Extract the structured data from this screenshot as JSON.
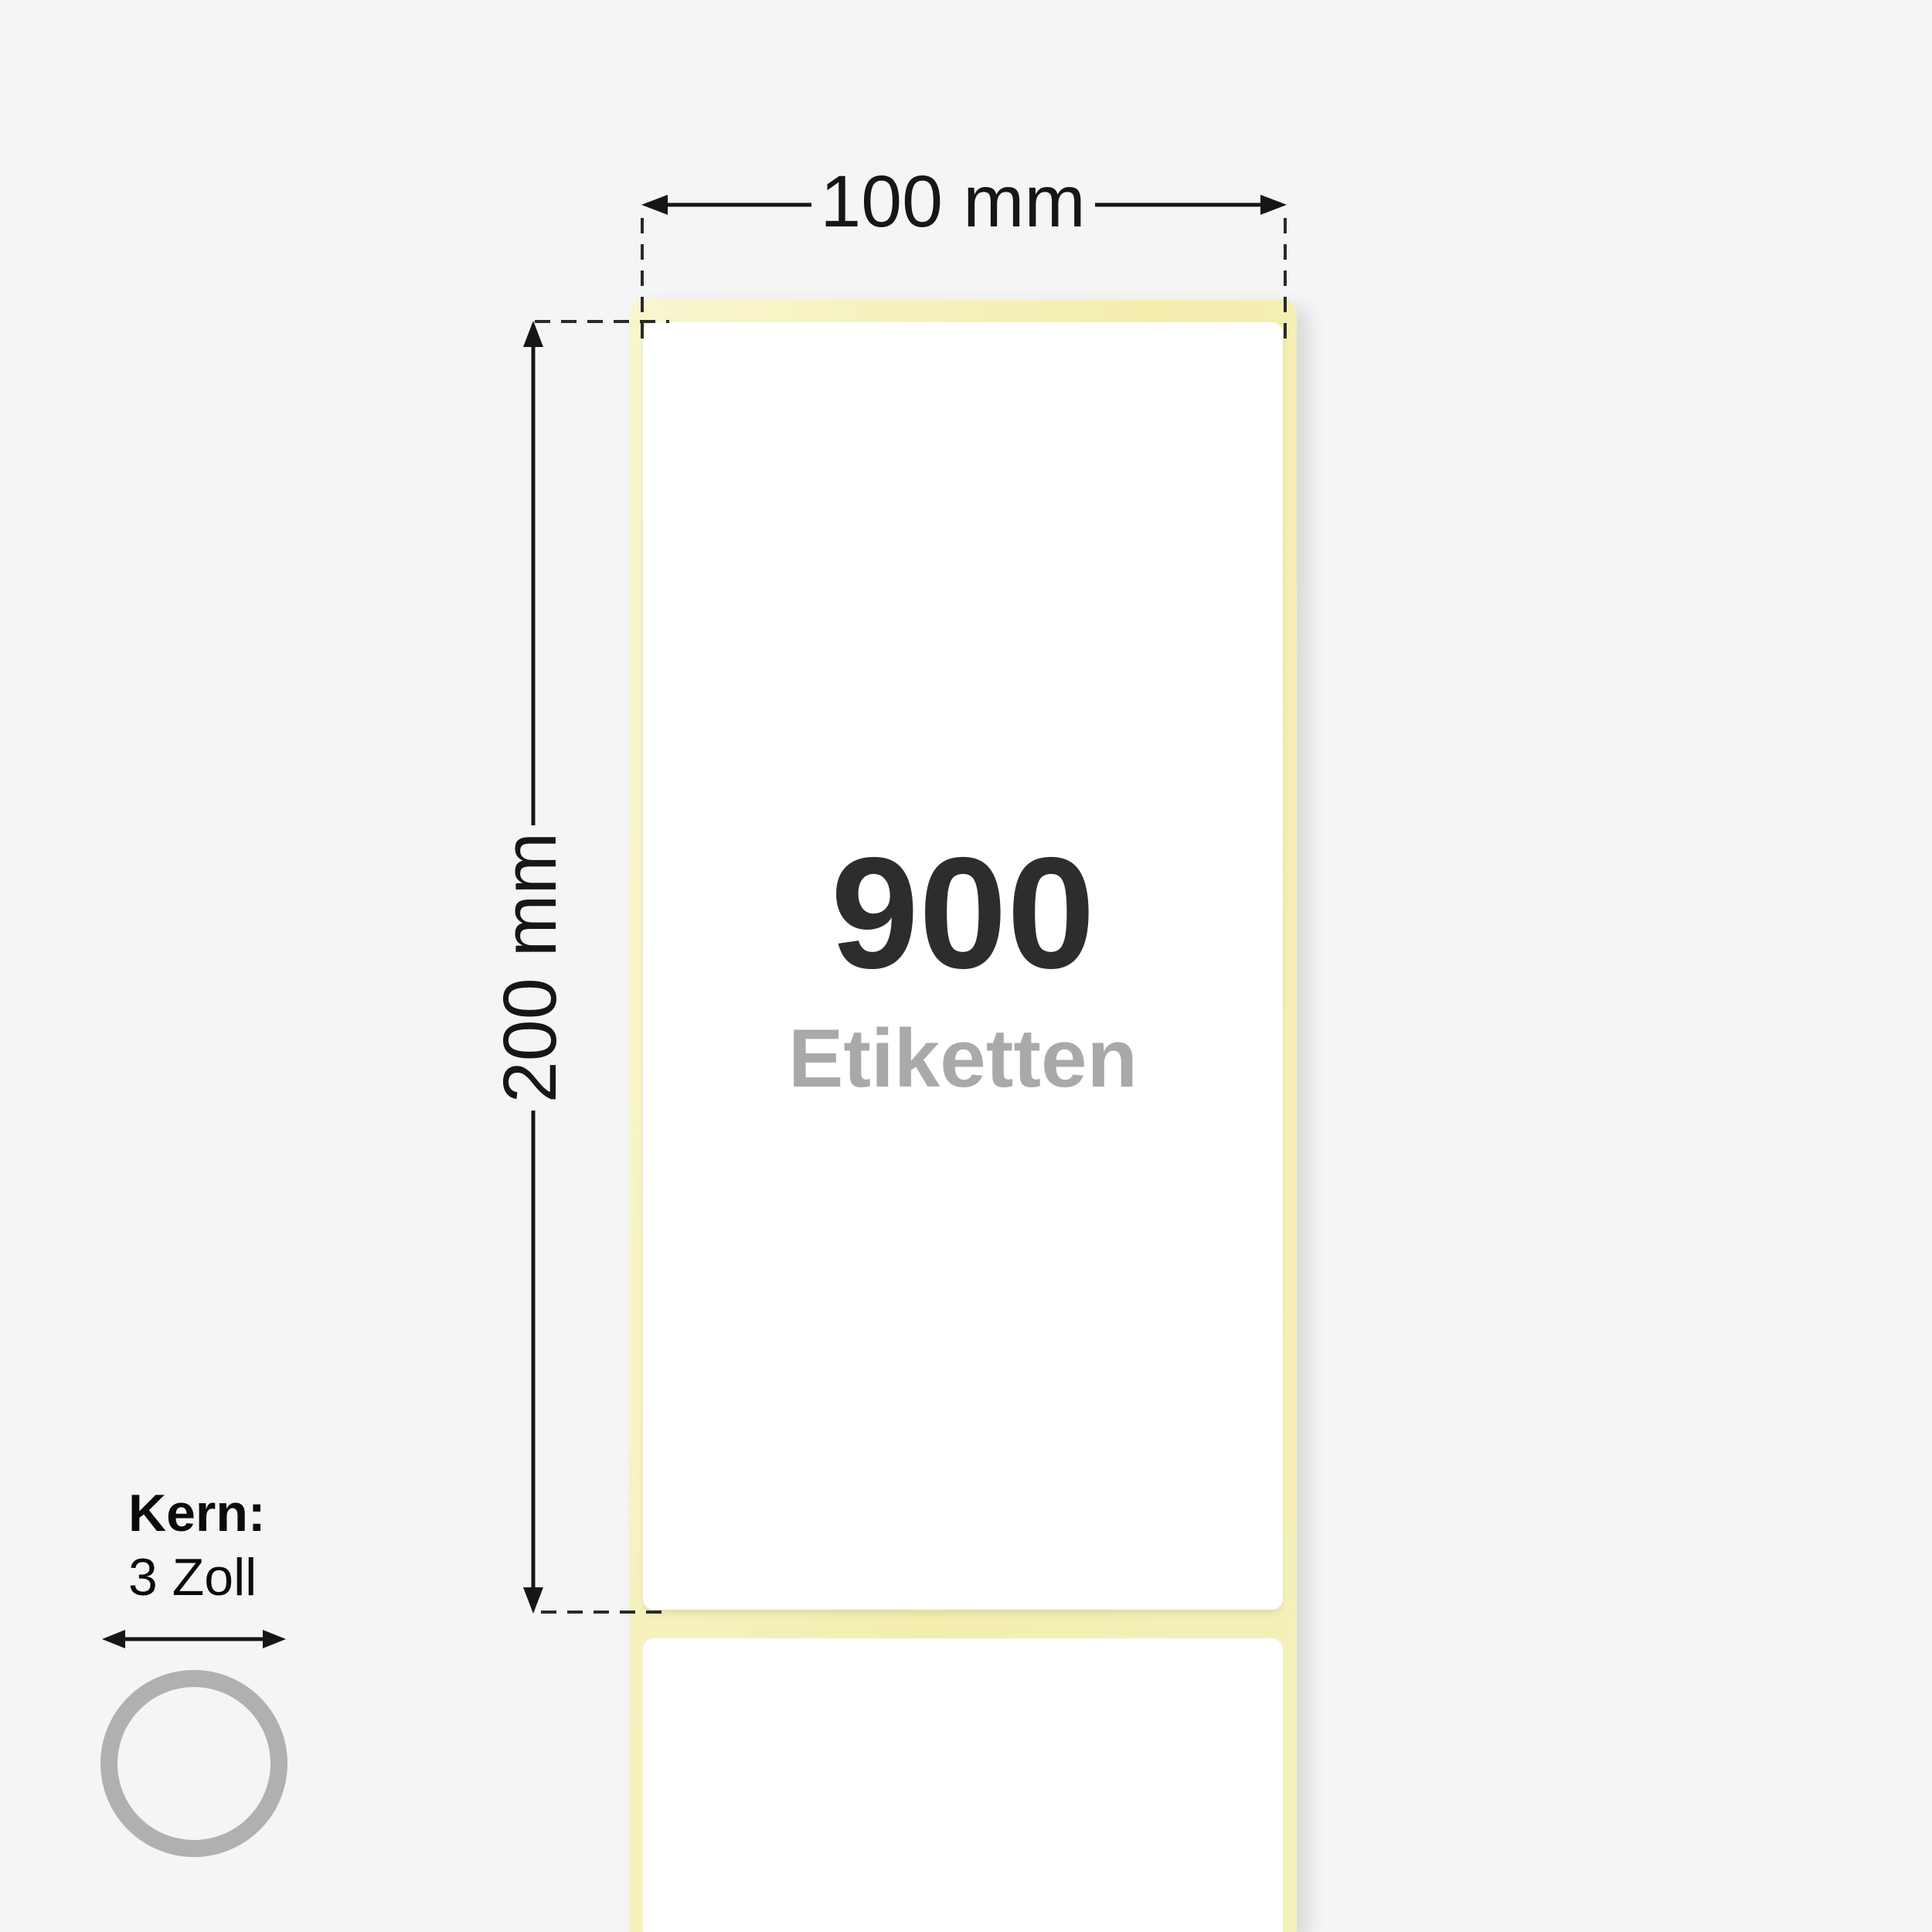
{
  "roll": {
    "count": "900",
    "unit": "Etiketten"
  },
  "dimensions": {
    "width": "100 mm",
    "height": "200 mm"
  },
  "core": {
    "title": "Kern:",
    "size": "3 Zoll"
  },
  "icons": {
    "width_arrow": "horizontal-double-arrow-icon",
    "height_arrow": "vertical-double-arrow-icon",
    "core_arrow": "horizontal-double-arrow-icon",
    "core_ring": "label-core-ring-icon"
  },
  "colors": {
    "background": "#f5f5f6",
    "liner": "#f5f1bb",
    "liner_light": "#f9f6cf",
    "label": "#ffffff",
    "count_text": "#2d2d2d",
    "unit_text": "#a9a9a9",
    "dimension": "#161616",
    "core_ring": "#b0b0b0"
  }
}
